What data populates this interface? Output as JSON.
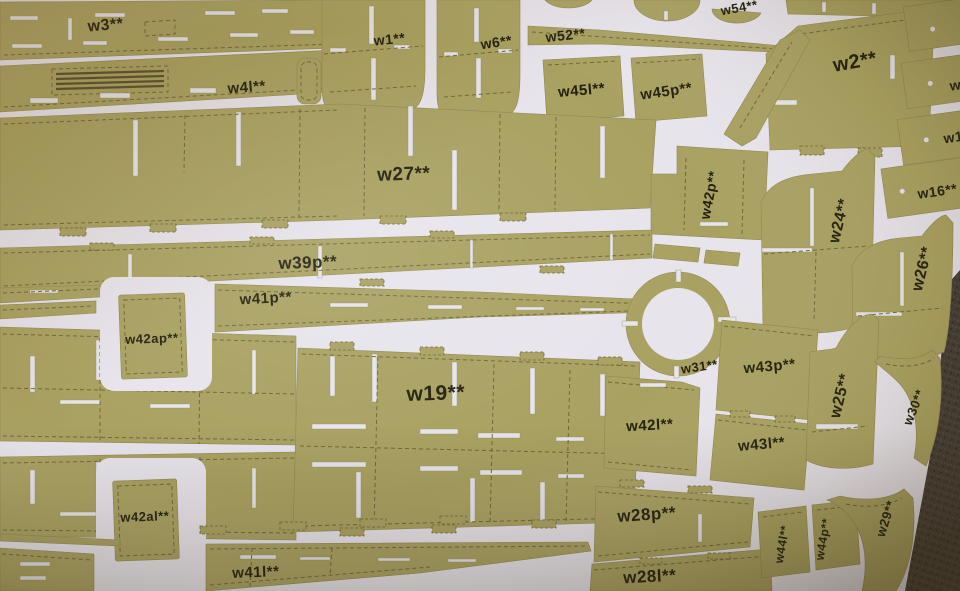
{
  "colors": {
    "cardboard": "#a9a161",
    "sheet": "#e7e4ec",
    "print": "#23200f",
    "fold_line": "#6e6738",
    "backdrop": "#3a342e"
  },
  "parts": {
    "w3": "w3**",
    "w4l": "w4l**",
    "w1": "w1**",
    "w6": "w6**",
    "w52": "w52**",
    "w54": "w54**",
    "w45l": "w45l**",
    "w45p": "w45p**",
    "w2": "w2**",
    "w27": "w27**",
    "w42p": "w42p**",
    "w24": "w24**",
    "w26": "w26**",
    "w16": "w16**",
    "edge_w1": "w1",
    "edge_w": "w",
    "w39p": "w39p**",
    "w41p": "w41p**",
    "w42ap": "w42ap**",
    "w31": "w31**",
    "w43p": "w43p**",
    "w25": "w25**",
    "w30": "w30**",
    "w19": "w19**",
    "w42l": "w42l**",
    "w43l": "w43l**",
    "w42al": "w42al**",
    "w28p": "w28p**",
    "w44l": "w44l**",
    "w44p": "w44p**",
    "w29": "w29**",
    "w41l": "w41l**",
    "w28l": "w28l**"
  }
}
